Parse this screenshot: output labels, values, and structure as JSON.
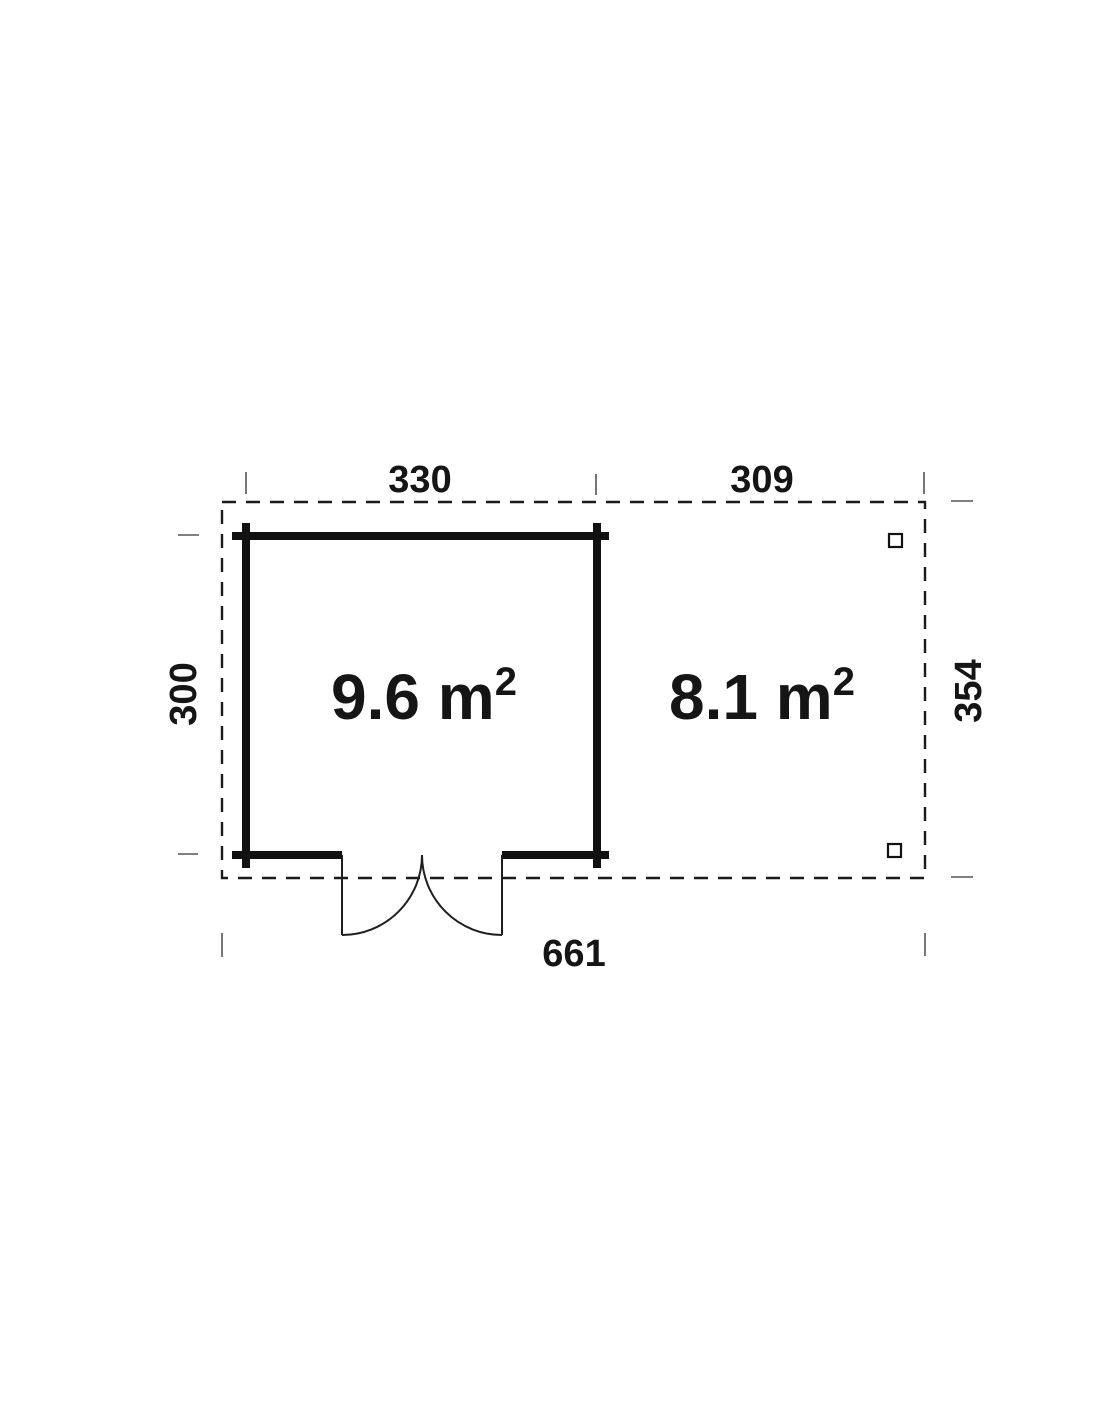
{
  "colors": {
    "line": "#1a1a1a",
    "wall": "#111111",
    "thin": "#1f1f1f",
    "tick": "#555555",
    "text": "#151515",
    "background": "#ffffff"
  },
  "plan": {
    "dimensions": {
      "top_left_width": "330",
      "top_right_width": "309",
      "left_depth": "300",
      "right_depth": "354",
      "total_width": "661"
    },
    "rooms": [
      {
        "name": "cabin",
        "area_main": "9.6 m",
        "area_exponent": "2"
      },
      {
        "name": "terrace",
        "area_main": "8.1 m",
        "area_exponent": "2"
      }
    ]
  }
}
